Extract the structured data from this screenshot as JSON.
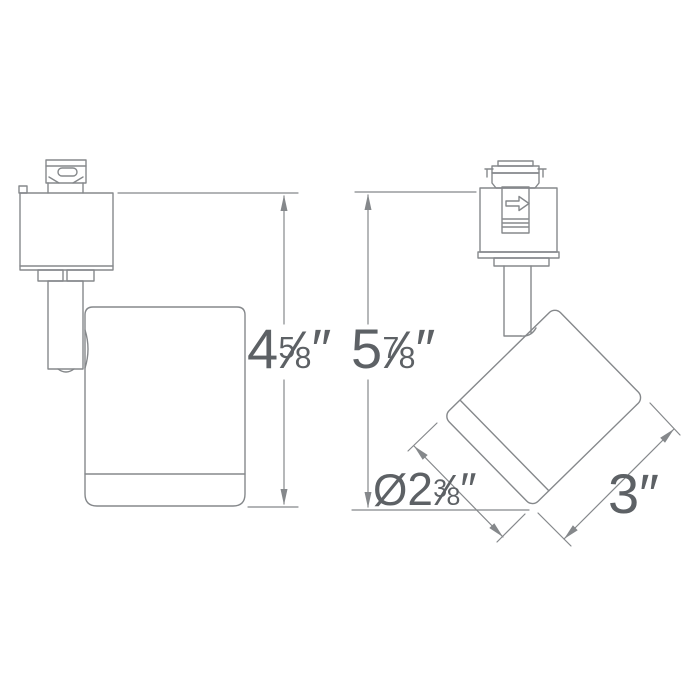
{
  "colors": {
    "background": "#ffffff",
    "line": "#85888b",
    "text": "#5d6165"
  },
  "icons": {
    "lever_arrow": "right-arrow"
  },
  "dimensions": {
    "side_height": {
      "whole": "4",
      "numerator": "5",
      "slash": "⁄",
      "denominator": "8",
      "unit": "″"
    },
    "front_height": {
      "whole": "5",
      "numerator": "7",
      "slash": "⁄",
      "denominator": "8",
      "unit": "″"
    },
    "head_diameter": {
      "prefix": "Ø",
      "whole": "2",
      "numerator": "3",
      "slash": "⁄",
      "denominator": "8",
      "unit": "″"
    },
    "head_length": {
      "whole": "3",
      "unit": "″"
    }
  }
}
